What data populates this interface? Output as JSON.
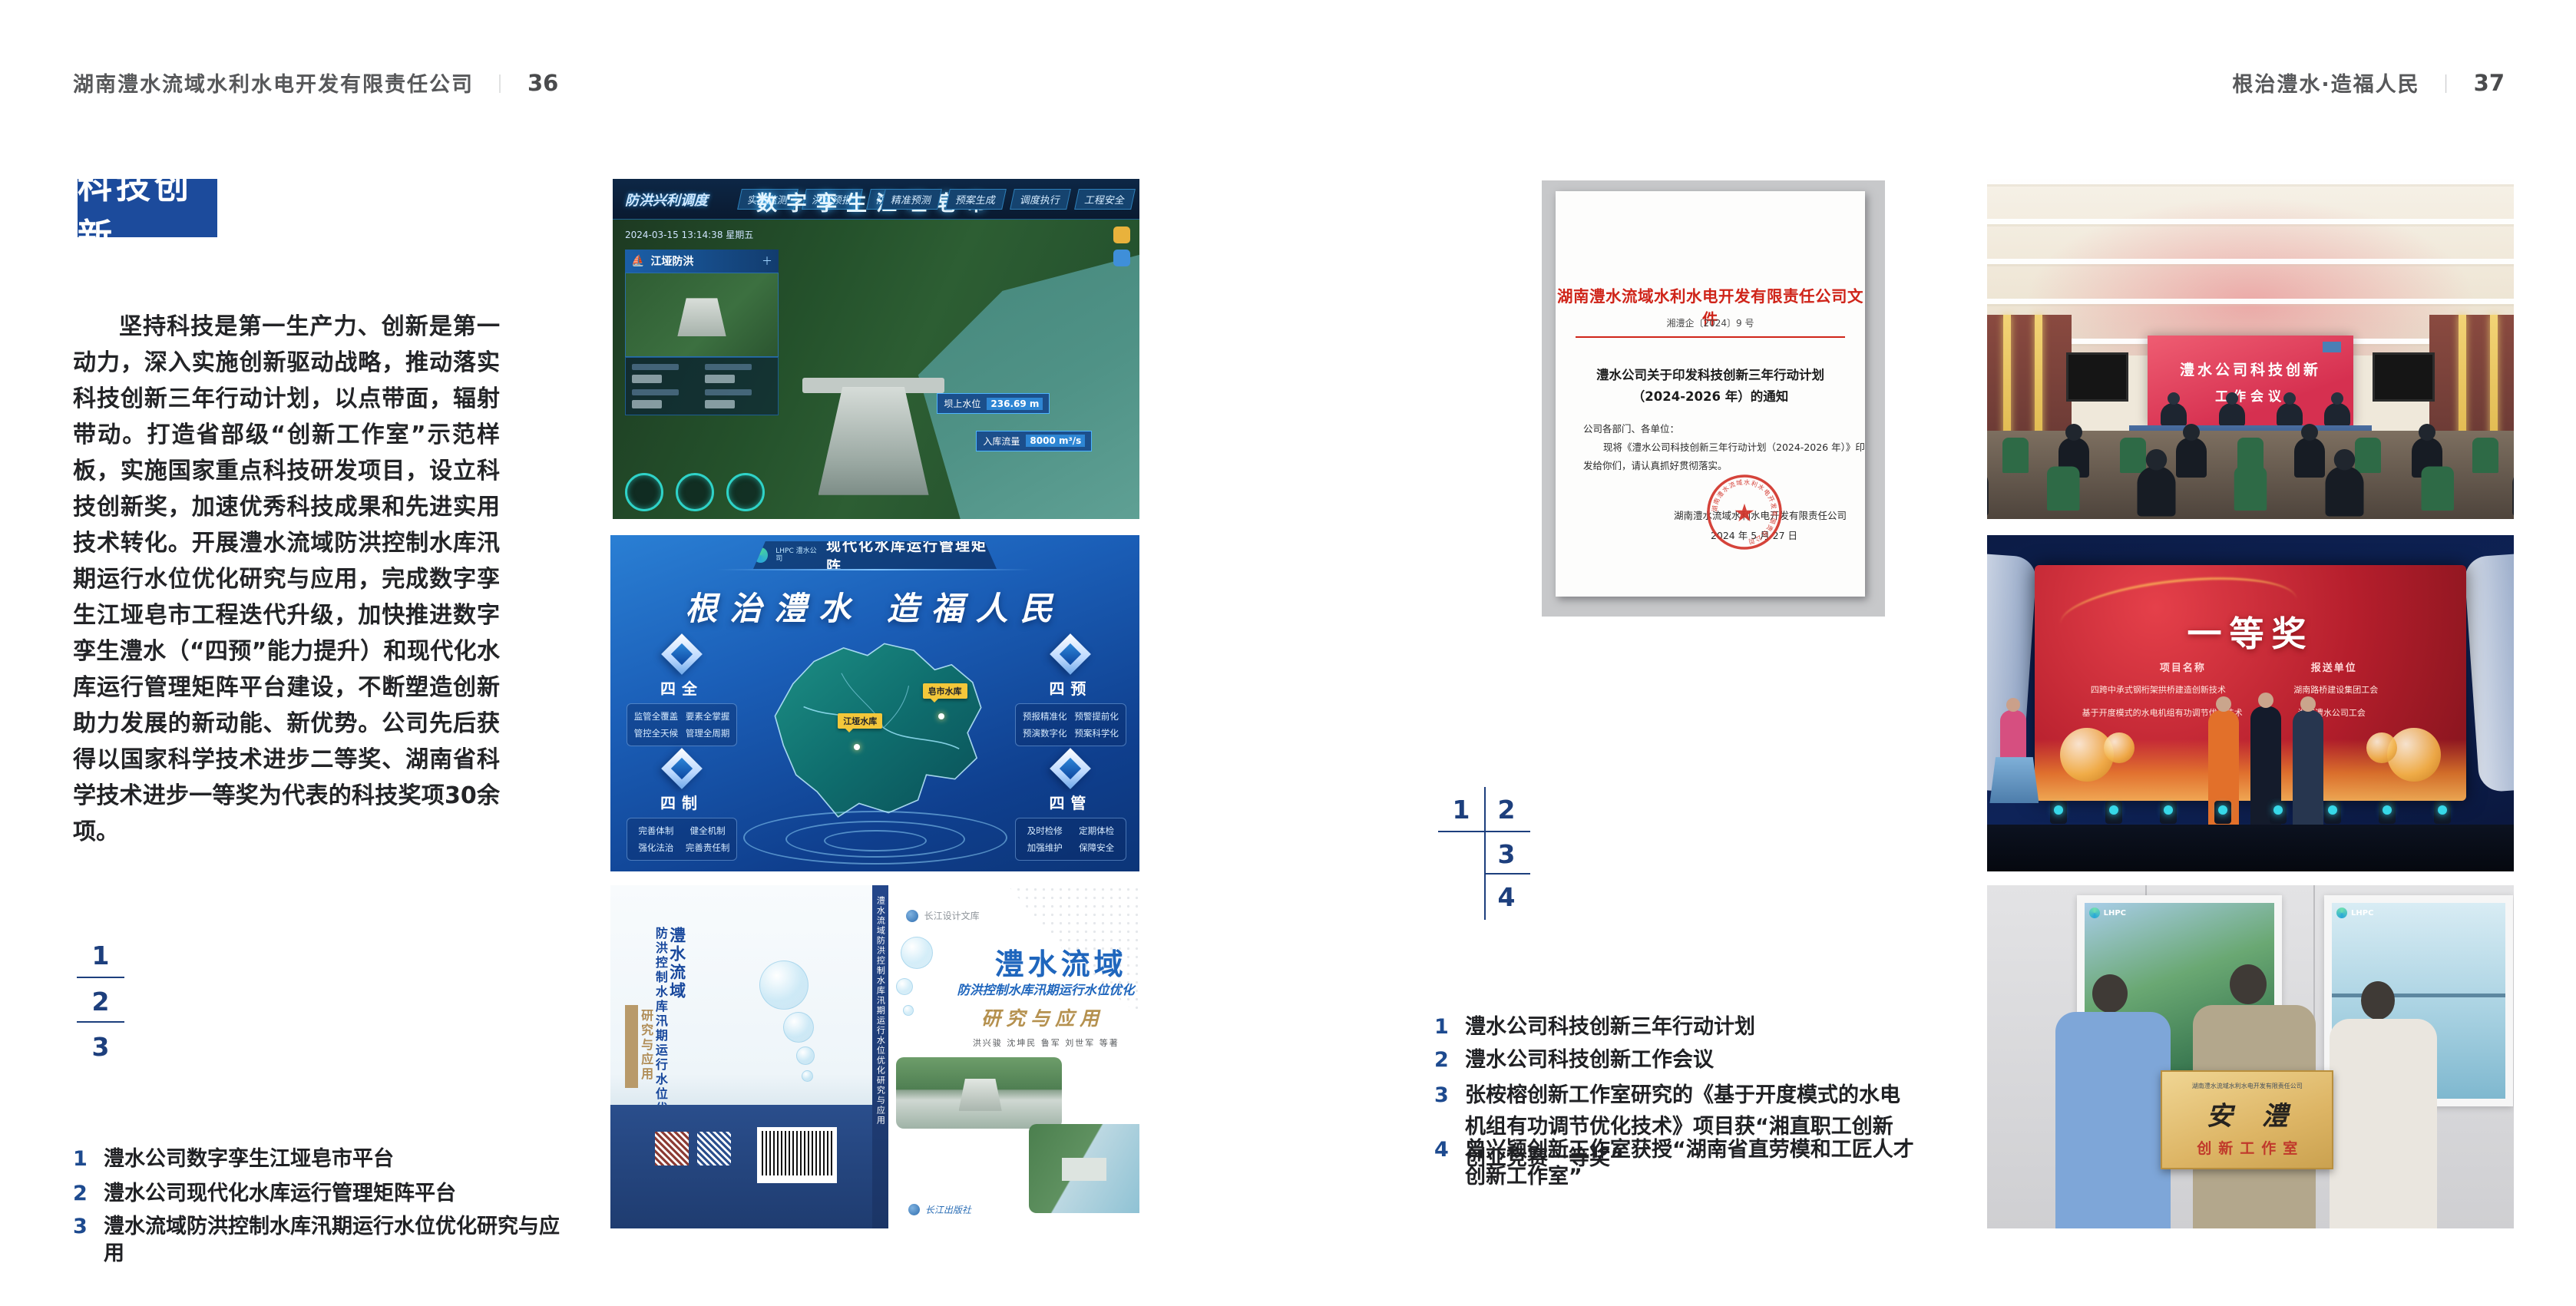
{
  "colors": {
    "accent_blue": "#1c4b9c",
    "index_navy": "#1d3f7d",
    "document_red": "#d3281e",
    "caption_num_blue": "#1d4a8f"
  },
  "left_page": {
    "header": {
      "company": "湖南澧水流域水利水电开发有限责任公司",
      "divider": "｜",
      "page": "36"
    },
    "section_title": "科技创新",
    "body": "坚持科技是第一生产力、创新是第一动力，深入实施创新驱动战略，推动落实科技创新三年行动计划，以点带面，辐射带动。打造省部级“创新工作室”示范样板，实施国家重点科技研发项目，设立科技创新奖，加速优秀科技成果和先进实用技术转化。开展澧水流域防洪控制水库汛期运行水位优化研究与应用，完成数字孪生江垭皂市工程迭代升级，加快推进数字孪生澧水（“四预”能力提升）和现代化水库运行管理矩阵平台建设，不断塑造创新助力发展的新动能、新优势。公司先后获得以国家科学技术进步二等奖、湖南省科学技术进步一等奖为代表的科技奖项30余项。",
    "figure_index": [
      "1",
      "2",
      "3"
    ],
    "captions": [
      {
        "num": "1",
        "text": "澧水公司数字孪生江垭皂市平台"
      },
      {
        "num": "2",
        "text": "澧水公司现代化水库运行管理矩阵平台"
      },
      {
        "num": "3",
        "text": "澧水流域防洪控制水库汛期运行水位优化研究与应用"
      }
    ]
  },
  "right_page": {
    "header": {
      "slogan": "根治澧水·造福人民",
      "divider": "｜",
      "page": "37"
    },
    "figure_index": [
      "1",
      "2",
      "3",
      "4"
    ],
    "captions": [
      {
        "num": "1",
        "text": "澧水公司科技创新三年行动计划"
      },
      {
        "num": "2",
        "text": "澧水公司科技创新工作会议"
      },
      {
        "num": "3",
        "text": "张桉榕创新工作室研究的《基于开度模式的水电机组有功调节优化技术》项目获“湘直职工创新创业竞赛一等奖”"
      },
      {
        "num": "4",
        "text": "曾兴颖创新工作室获授“湖南省直劳模和工匠人才创新工作室”"
      }
    ]
  },
  "figures": {
    "dashboard": {
      "title": "数字孪生江垭皂市",
      "module": "防洪兴利调度",
      "tabs_left": [
        "实时监测",
        "洪水预报",
        "防洪预警"
      ],
      "tabs_right": [
        "精准预测",
        "预案生成",
        "调度执行",
        "工程安全"
      ],
      "timestamp": "2024-03-15 13:14:38 星期五",
      "panel_title": "江垭防洪",
      "stats": [
        {
          "label": "坝上水位",
          "value": "236.69 m"
        },
        {
          "label": "入库流量",
          "value": "8000 m³/s"
        }
      ]
    },
    "matrix": {
      "logo_text": "LHPC 澧水公司",
      "title": "现代化水库运行管理矩阵",
      "slogan": "根治澧水 造福人民",
      "map_tags": [
        "江垭水库",
        "皂市水库"
      ],
      "panels": [
        {
          "title": "四全",
          "items": [
            "监管全覆盖",
            "要素全掌握",
            "管控全天候",
            "管理全周期"
          ]
        },
        {
          "title": "四预",
          "items": [
            "预报精准化",
            "预警提前化",
            "预演数字化",
            "预案科学化"
          ]
        },
        {
          "title": "四制",
          "items": [
            "完善体制",
            "健全机制",
            "强化法治",
            "完善责任制"
          ]
        },
        {
          "title": "四管",
          "items": [
            "及时检修",
            "定期体检",
            "加强维护",
            "保障安全"
          ]
        }
      ]
    },
    "book": {
      "series": "长江设计文库",
      "title": "澧水流域",
      "subtitle": "防洪控制水库汛期运行水位优化",
      "accent": "研究与应用",
      "authors": "洪兴骏 沈坤民 鲁军 刘世军 等著",
      "spine": "澧水流域防洪控制水库汛期运行水位优化研究与应用",
      "back_title_1": "澧水流域",
      "back_title_2": "防洪控制水库汛期运行水位优化",
      "back_title_3": "研究与应用",
      "publisher": "长江出版社"
    },
    "document": {
      "header": "湖南澧水流域水利水电开发有限责任公司文件",
      "doc_no": "湘澧企〔2024〕9 号",
      "title_line1": "澧水公司关于印发科技创新三年行动计划",
      "title_line2": "（2024-2026 年）的通知",
      "salutation": "公司各部门、各单位：",
      "body_line1": "现将《澧水公司科技创新三年行动计划（2024-2026 年）》印",
      "body_line2": "发给你们，请认真抓好贯彻落实。",
      "signer": "湖南澧水流域水利水电开发有限责任公司",
      "date": "2024 年 5 月 27 日",
      "seal_text": "湖南澧水流域水利水电开发有限责任公司"
    },
    "meeting": {
      "screen_line1": "澧水公司科技创新",
      "screen_line2": "工作会议"
    },
    "award": {
      "title": "一等奖",
      "col_project": "项目名称",
      "col_unit": "报送单位",
      "rows": [
        {
          "project": "四跨中承式钢桁架拱桥建造创新技术",
          "unit": "湖南路桥建设集团工会"
        },
        {
          "project": "基于开度模式的水电机组有功调节优化技术",
          "unit": "湖南澧水公司工会"
        }
      ]
    },
    "plaque": {
      "logo": "LHPC",
      "header": "湖南澧水流域水利水电开发有限责任公司",
      "name": "安澧",
      "subtitle": "创新工作室"
    }
  }
}
